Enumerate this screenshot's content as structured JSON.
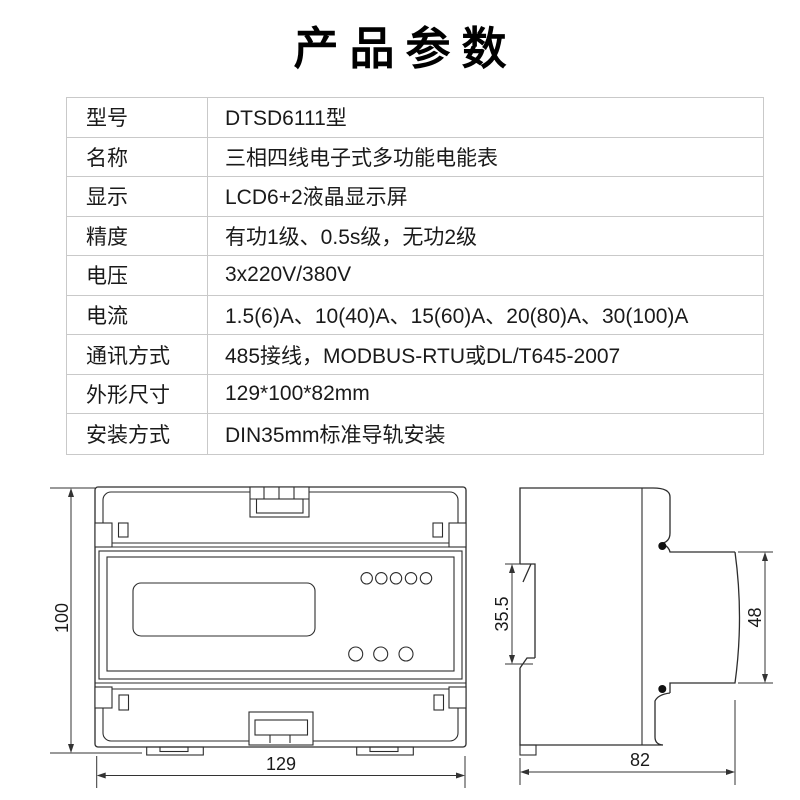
{
  "title": "产品参数",
  "table": {
    "rows": [
      {
        "label": "型号",
        "value": "DTSD6111型"
      },
      {
        "label": "名称",
        "value": "三相四线电子式多功能电能表"
      },
      {
        "label": "显示",
        "value": "LCD6+2液晶显示屏"
      },
      {
        "label": "精度",
        "value": "有功1级、0.5s级，无功2级"
      },
      {
        "label": "电压",
        "value": "3x220V/380V"
      },
      {
        "label": "电流",
        "value": "1.5(6)A、10(40)A、15(60)A、20(80)A、30(100)A"
      },
      {
        "label": "通讯方式",
        "value": "485接线，MODBUS-RTU或DL/T645-2007"
      },
      {
        "label": "外形尺寸",
        "value": "129*100*82mm"
      },
      {
        "label": "安装方式",
        "value": "DIN35mm标准导轨安装"
      }
    ]
  },
  "drawings": {
    "front": {
      "width_label": "129",
      "height_label": "100"
    },
    "side": {
      "depth_label": "82",
      "rail_label": "35.5",
      "face_label": "48"
    }
  },
  "colors": {
    "line": "#2d2d2d",
    "dimension_line": "#333333",
    "table_grid": "#c9c9c9",
    "text": "#1a1a1a"
  }
}
